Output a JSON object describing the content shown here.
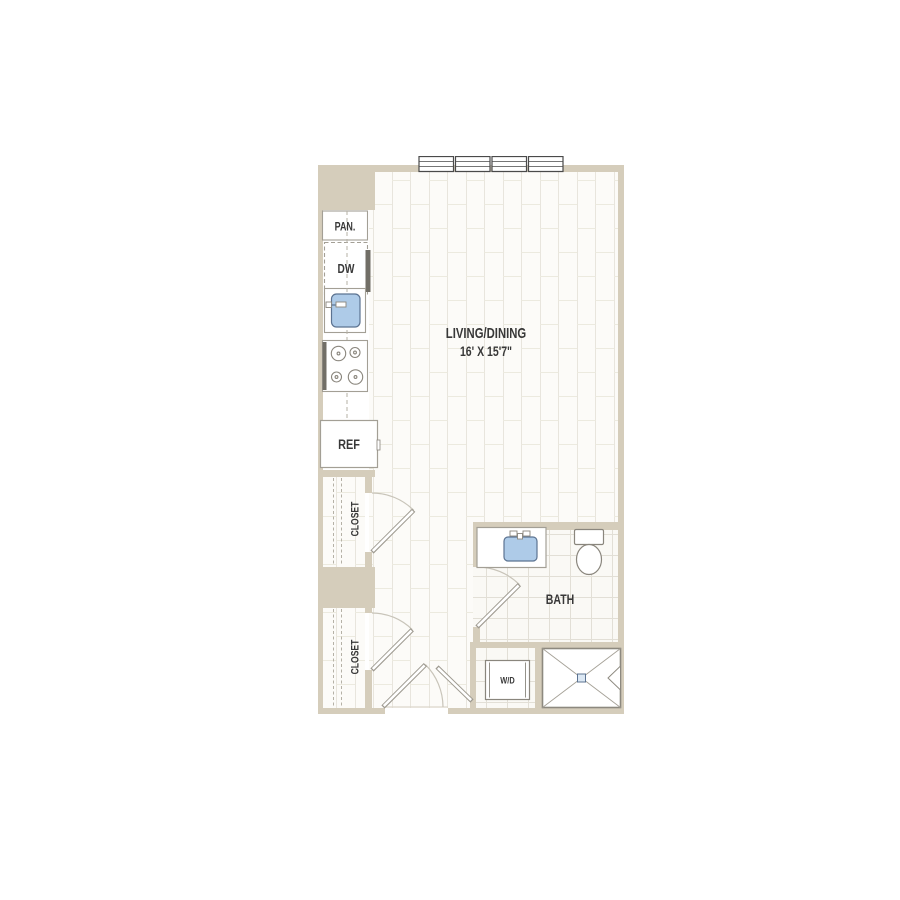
{
  "rooms": {
    "living_dining": {
      "name": "LIVING/DINING",
      "dimensions": "16' X 15'7\""
    },
    "bath": {
      "name": "BATH"
    },
    "closet_upper": {
      "name": "CLOSET"
    },
    "closet_lower": {
      "name": "CLOSET"
    }
  },
  "fixtures": {
    "pantry": "PAN.",
    "dishwasher": "DW",
    "refrigerator": "REF",
    "washer_dryer": "W/D"
  },
  "colors": {
    "wall": "#d5cdbb",
    "fixture_outline": "#a39f95",
    "appliance_dark": "#716e66",
    "water_fixture_fill": "#aecbe8",
    "water_fixture_border": "#5c7391",
    "plank_line": "#e8e5dd",
    "tile_line": "#e2dfd6",
    "label_text": "#383838"
  }
}
